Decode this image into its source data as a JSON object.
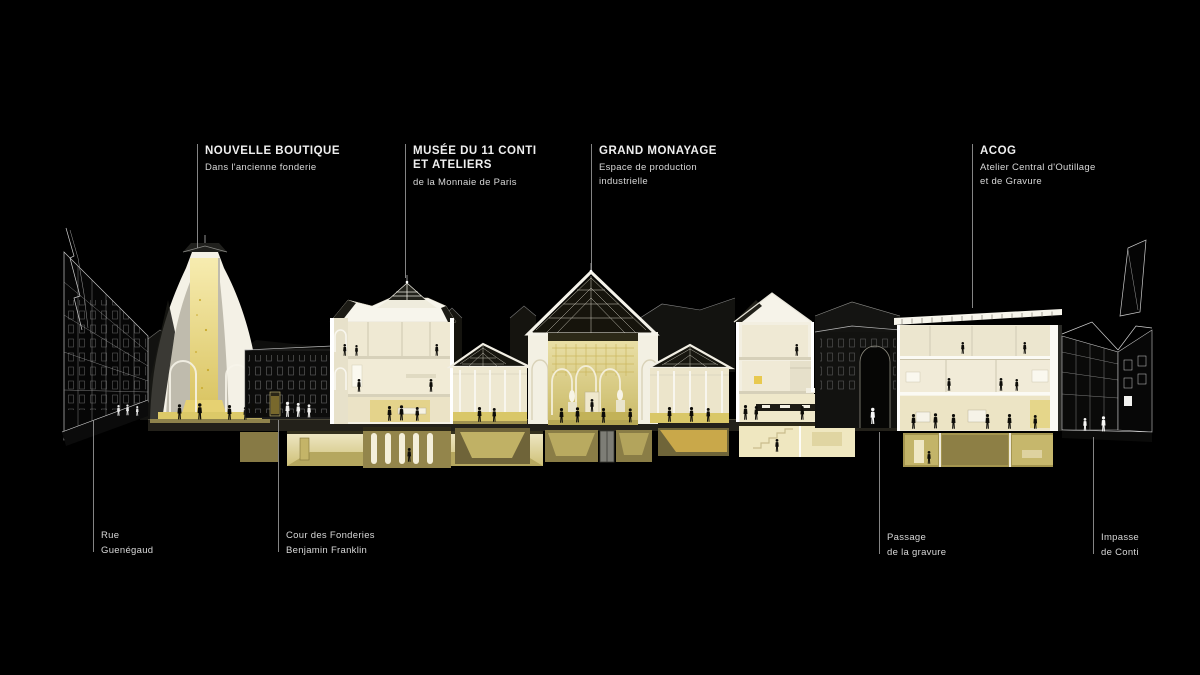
{
  "canvas": {
    "background": "#000000"
  },
  "callouts_top": [
    {
      "title_lines": [
        "NOUVELLE BOUTIQUE",
        ""
      ],
      "subtitle_lines": [
        "Dans l'ancienne fonderie",
        ""
      ]
    },
    {
      "title_lines": [
        "MUSÉE DU 11 CONTI",
        "ET ATELIERS"
      ],
      "subtitle_lines": [
        "de la Monnaie de Paris",
        ""
      ]
    },
    {
      "title_lines": [
        "GRAND MONAYAGE",
        ""
      ],
      "subtitle_lines": [
        "Espace de production",
        "industrielle"
      ]
    },
    {
      "title_lines": [
        "ACOG",
        ""
      ],
      "subtitle_lines": [
        "Atelier Central d'Outillage",
        "et de Gravure"
      ]
    }
  ],
  "callouts_bottom": [
    {
      "lines": [
        "Rue",
        "Guenégaud"
      ]
    },
    {
      "lines": [
        "Cour des Fonderies",
        "Benjamin Franklin"
      ]
    },
    {
      "lines": [
        "Passage",
        "de la gravure"
      ]
    },
    {
      "lines": [
        "Impasse",
        "de Conti"
      ]
    }
  ],
  "colors": {
    "background": "#000000",
    "label_text": "#efefef",
    "label_subtext": "#d8d8d8",
    "leader_line": "#9b9b9b",
    "building_white": "#f5f2e7",
    "interior_cream": "#ece5cc",
    "glow_gold": "#d9c36a",
    "basement_olive": "#8d7f48",
    "roof_dark": "#16140e"
  }
}
